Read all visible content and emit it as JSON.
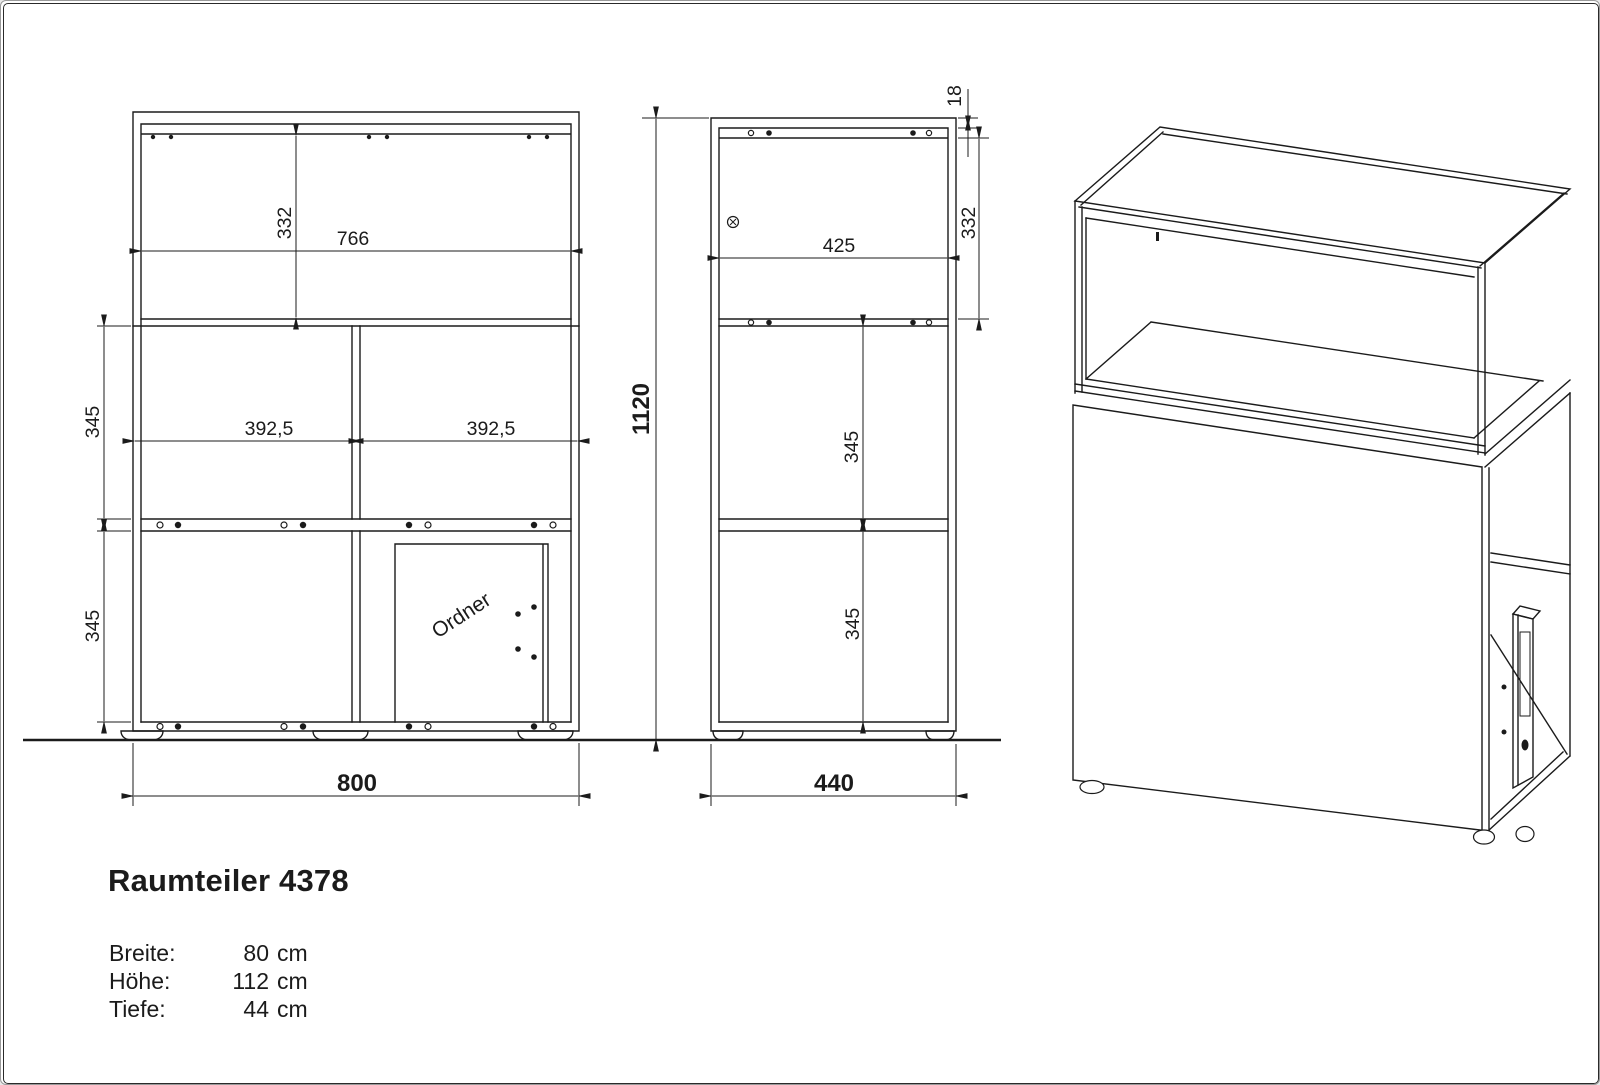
{
  "drawing": {
    "title": "Raumteiler 4378",
    "colors": {
      "ink": "#1b1b1b",
      "background": "#ffffff"
    },
    "specs": {
      "breite_label": "Breite:",
      "breite_value": "80",
      "breite_unit": "cm",
      "hoehe_label": "Höhe:",
      "hoehe_value": "112",
      "hoehe_unit": "cm",
      "tiefe_label": "Tiefe:",
      "tiefe_value": "44",
      "tiefe_unit": "cm"
    },
    "front_view": {
      "inner_width": "766",
      "upper_height": "332",
      "cell_width_left": "392,5",
      "cell_width_right": "392,5",
      "mid_height": "345",
      "lower_height": "345",
      "overall_width": "800",
      "binder_label": "Ordner"
    },
    "side_view": {
      "overall_height": "1120",
      "top_thickness": "18",
      "upper_height": "332",
      "inner_depth": "425",
      "mid_height": "345",
      "lower_height": "345",
      "overall_depth": "440"
    }
  }
}
